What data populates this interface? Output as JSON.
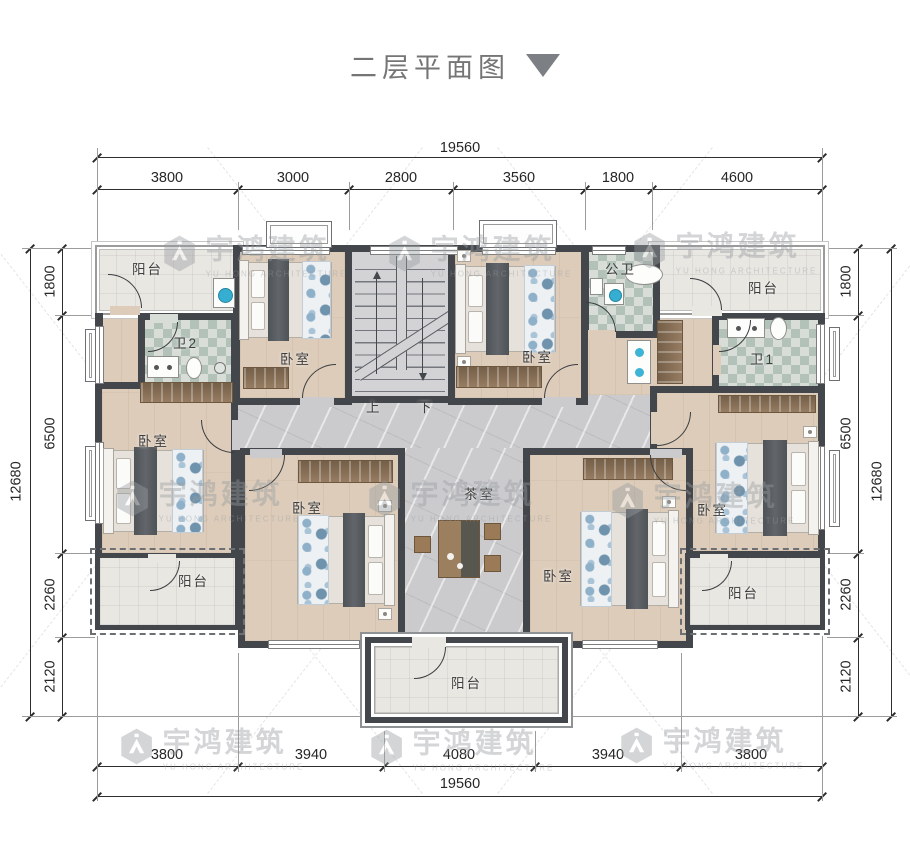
{
  "title": {
    "text": "二层平面图",
    "icon": "triangle-down"
  },
  "watermark": {
    "cn": "宇鸿建筑",
    "en": "YU HONG ARCHITECTURE"
  },
  "dimensions": {
    "top": {
      "total": "19560",
      "segments": [
        "3800",
        "3000",
        "2800",
        "3560",
        "1800",
        "4600"
      ]
    },
    "bottom": {
      "total": "19560",
      "segments": [
        "3800",
        "3940",
        "4080",
        "3940",
        "3800"
      ]
    },
    "left": {
      "total": "12680",
      "segments": [
        "1800",
        "6500",
        "2260",
        "2120"
      ]
    },
    "right": {
      "total": "12680",
      "segments": [
        "1800",
        "6500",
        "2260",
        "2120"
      ]
    }
  },
  "room_labels": {
    "balcony": "阳台",
    "bedroom": "卧室",
    "bath1": "卫1",
    "bath2": "卫2",
    "public_bath": "公卫",
    "tea_room": "茶室"
  },
  "stairs": {
    "up": "上",
    "down": "下"
  },
  "colors": {
    "wall": "#43464a",
    "wood_floor": "#ddccba",
    "marble_floor": "#cbcbce",
    "bath_tile": "#b2c2b8",
    "balcony_floor": "#e9e7e2",
    "furniture_wood": "#97785a",
    "dimension_text": "#262626",
    "title_text": "#757575",
    "watermark": "#989da1"
  }
}
